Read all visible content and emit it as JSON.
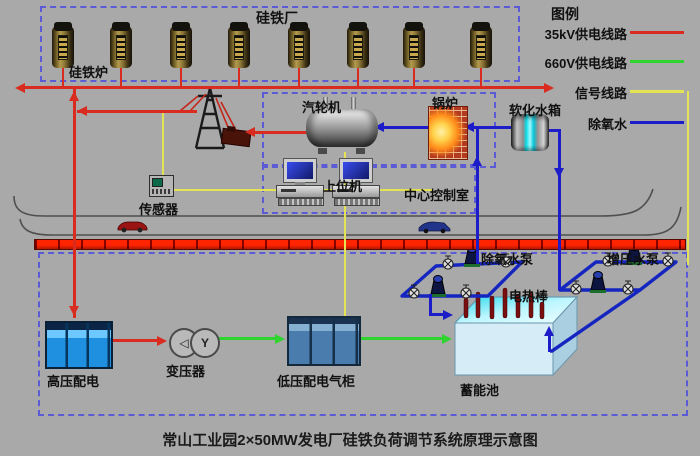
{
  "title": "常山工业园2×50MW发电厂硅铁负荷调节系统原理示意图",
  "legend": {
    "title": "图例",
    "items": [
      {
        "label": "35kV供电线路",
        "color": "#d92b20"
      },
      {
        "label": "660V供电线路",
        "color": "#2fd42f"
      },
      {
        "label": "信号线路",
        "color": "#e3e353"
      },
      {
        "label": "除氧水",
        "color": "#1c1cc8"
      }
    ]
  },
  "labels": {
    "plant": "硅铁厂",
    "furnace": "硅铁炉",
    "turbine": "汽轮机",
    "boiler": "锅炉",
    "softened_tank": "软化水箱",
    "host_computer": "上位机",
    "control_room": "中心控制室",
    "sensor": "传感器",
    "deaeration_pumps": "除氧水泵",
    "booster_pumps": "增压水泵",
    "heater_rods": "电热棒",
    "storage_pool": "蓄能池",
    "hv_distribution": "高压配电",
    "transformer": "变压器",
    "lv_cabinet": "低压配电气柜"
  },
  "transformer_symbols": {
    "primary": "◁",
    "secondary": "Y"
  },
  "furnace_count": 8,
  "colors": {
    "background": "#a9a9a9",
    "dashed_border": "#5b5bd6",
    "power_35kv": "#d92b20",
    "power_660v": "#2fd42f",
    "signal": "#e3e353",
    "water": "#1c1cc8",
    "cable_tray": "#ff2400"
  }
}
